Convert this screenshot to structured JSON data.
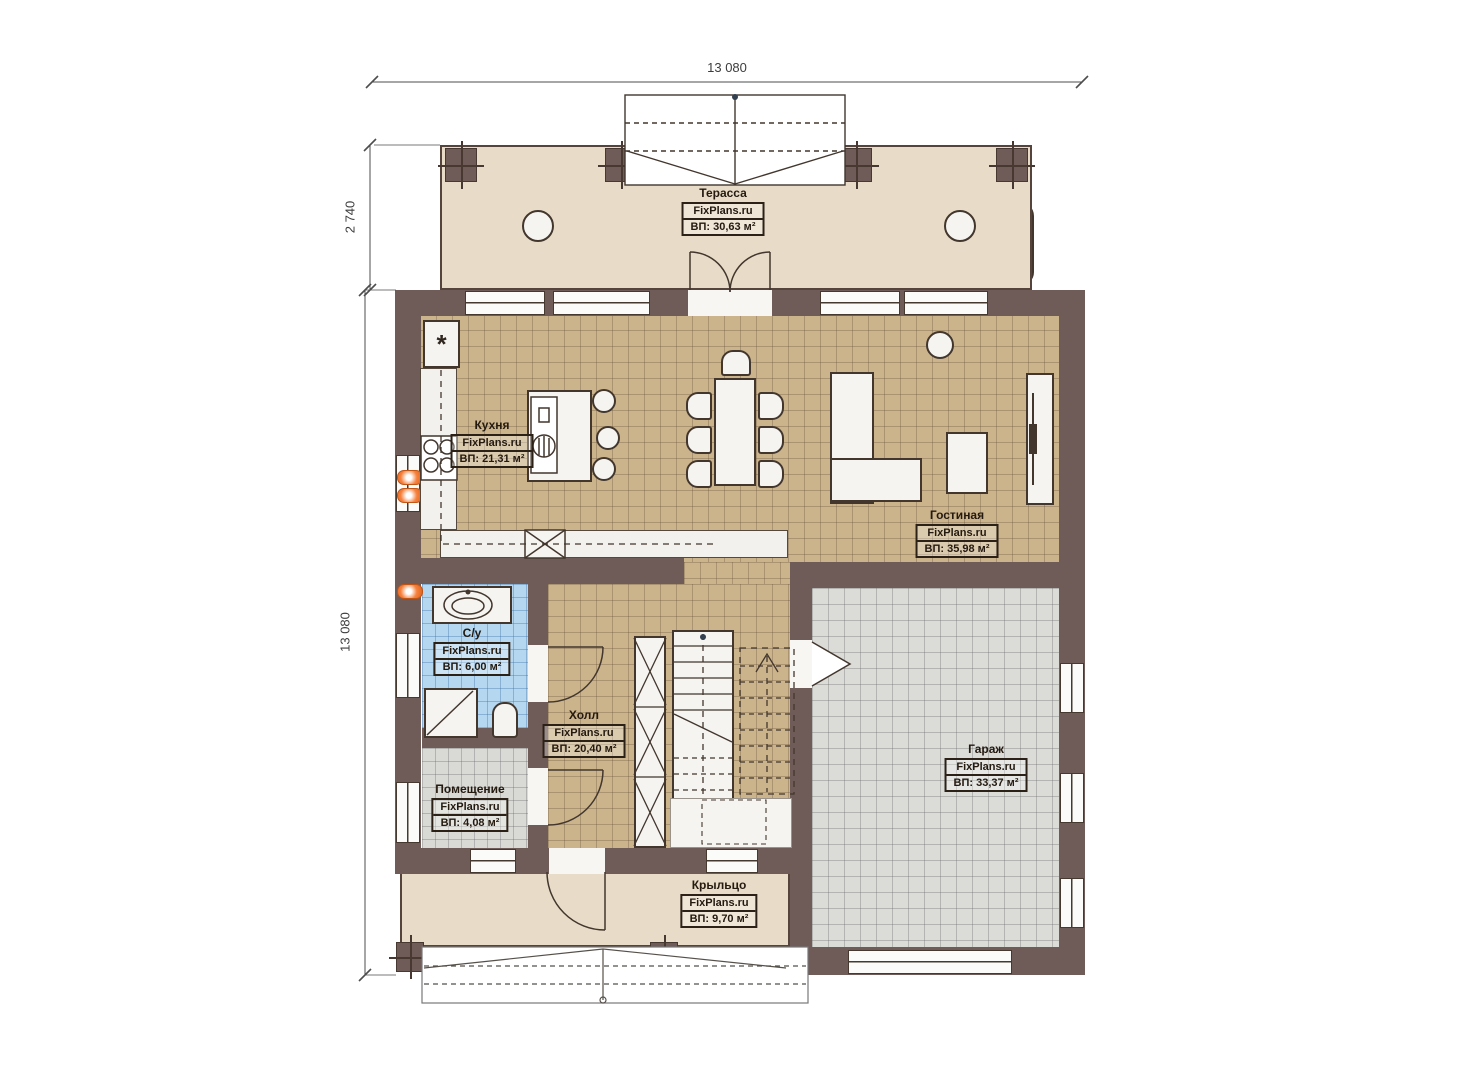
{
  "plan": {
    "brand": "FixPlans.ru",
    "dimensions": {
      "width_top": "13 080",
      "terrace_depth": "2 740",
      "height_left": "13 080"
    },
    "rooms": [
      {
        "key": "terrace",
        "name": "Терасса",
        "brand": "FixPlans.ru",
        "area": "ВП: 30,63 м²"
      },
      {
        "key": "kitchen",
        "name": "Кухня",
        "brand": "FixPlans.ru",
        "area": "ВП: 21,31 м²"
      },
      {
        "key": "living",
        "name": "Гостиная",
        "brand": "FixPlans.ru",
        "area": "ВП: 35,98 м²"
      },
      {
        "key": "bathroom",
        "name": "С/у",
        "brand": "FixPlans.ru",
        "area": "ВП: 6,00 м²"
      },
      {
        "key": "hall",
        "name": "Холл",
        "brand": "FixPlans.ru",
        "area": "ВП: 20,40 м²"
      },
      {
        "key": "utility",
        "name": "Помещение",
        "brand": "FixPlans.ru",
        "area": "ВП: 4,08 м²"
      },
      {
        "key": "garage",
        "name": "Гараж",
        "brand": "FixPlans.ru",
        "area": "ВП: 33,37 м²"
      },
      {
        "key": "porch",
        "name": "Крыльцо",
        "brand": "FixPlans.ru",
        "area": "ВП: 9,70 м²"
      }
    ],
    "icons": {
      "fridge": "*"
    },
    "colors": {
      "wall": "#6f5c59",
      "terrace_floor": "#e8dcc8",
      "tile_tan": "#cbb48c",
      "tile_blue": "#b5d7ef",
      "tile_gray": "#dbdbd8",
      "fixture_white": "#f5f4f1",
      "radiator_orange": "#f5813e",
      "line_dark": "#42362d"
    }
  }
}
